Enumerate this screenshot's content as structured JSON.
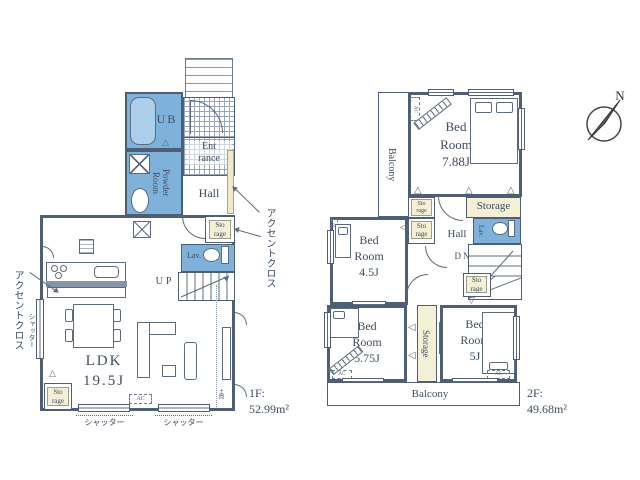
{
  "compass": {
    "north_label": "N"
  },
  "icons": {
    "fold_up": "△",
    "fold_down": "▽",
    "fold_left": "◁"
  },
  "floor1": {
    "floor_label": "1F:",
    "floor_area": "52.99m²",
    "ub_label": "UB",
    "powder_label": "Powder\nRoom",
    "entrance_label": "Ent\nrance",
    "hall_label": "Hall",
    "storage_mid_label": "Sto\nrage",
    "storage_bottom_label": "Sto\nrage",
    "lav_label": "Lav.",
    "up_label": "UP",
    "ldk_label": "LDK\n19.5J",
    "ac_label": "AC",
    "doma_label": "土間",
    "shutter_left_label": "シャッター",
    "shutter_bottom1_label": "シャッター",
    "shutter_bottom2_label": "シャッター",
    "accent_left_label": "アクセントクロス",
    "accent_right_label": "アクセントクロス"
  },
  "floor2": {
    "floor_label": "2F:",
    "floor_area": "49.68m²",
    "balcony_left_label": "Balcony",
    "balcony_bottom_label": "Balcony",
    "bedroom_788_label": "Bed\nRoom\n7.88J",
    "bedroom_45_label": "Bed\nRoom\n4.5J",
    "bedroom_575_label": "Bed\nRoom\n5.75J",
    "bedroom_5_label": "Bed\nRoom\n5J",
    "storage_main_label": "Storage",
    "storage_vertical_label": "Storage",
    "storage_small1_label": "Sto\nrage",
    "storage_small2_label": "Sto\nrage",
    "storage_small3_label": "Sto\nrage",
    "hall_label": "Hall",
    "lav_label": "Lav.",
    "dn_label": "DN",
    "ac1_label": "AC",
    "ac2_label": "AC",
    "ac3_label": "AC",
    "ac4_label": "AC"
  }
}
